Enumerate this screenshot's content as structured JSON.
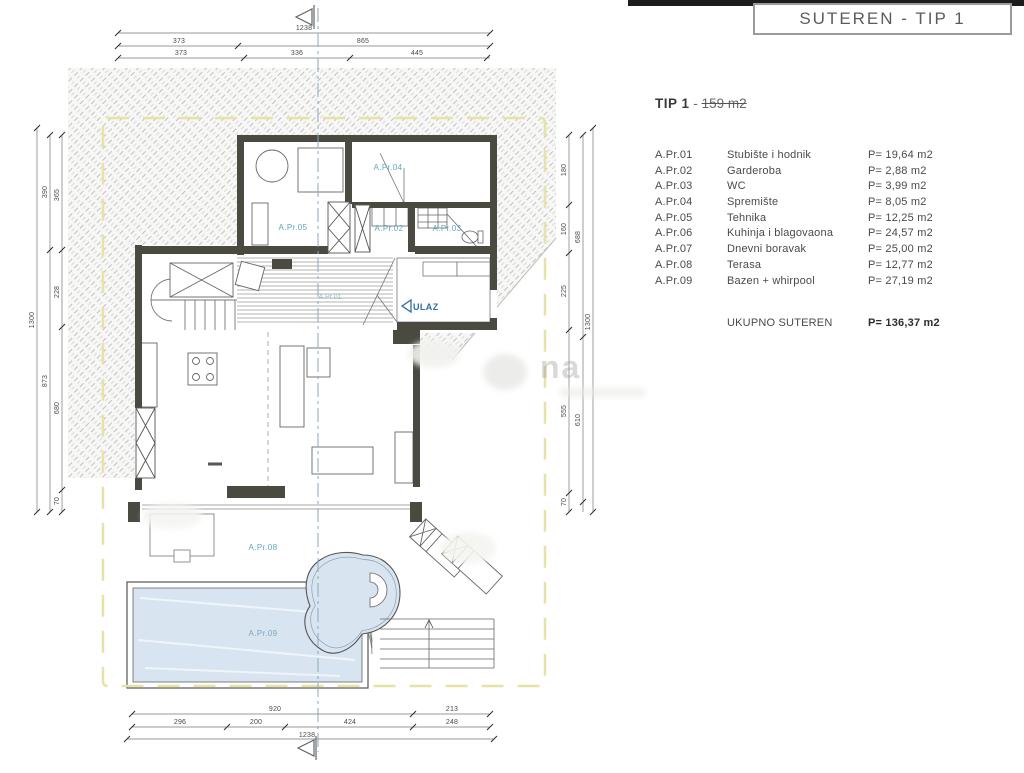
{
  "header": {
    "title": "SUTEREN - TIP 1"
  },
  "summary": {
    "title_bold": "TIP 1",
    "dash": "-",
    "area_struck": "159 m2"
  },
  "legend": {
    "rows": [
      {
        "code": "A.Pr.01",
        "name": "Stubište i hodnik",
        "area": "P= 19,64 m2"
      },
      {
        "code": "A.Pr.02",
        "name": "Garderoba",
        "area": "P= 2,88 m2"
      },
      {
        "code": "A.Pr.03",
        "name": "WC",
        "area": "P= 3,99 m2"
      },
      {
        "code": "A.Pr.04",
        "name": "Spremište",
        "area": "P= 8,05 m2"
      },
      {
        "code": "A.Pr.05",
        "name": "Tehnika",
        "area": "P= 12,25 m2"
      },
      {
        "code": "A.Pr.06",
        "name": "Kuhinja i blagovaona",
        "area": "P= 24,57 m2"
      },
      {
        "code": "A.Pr.07",
        "name": "Dnevni boravak",
        "area": "P= 25,00 m2"
      },
      {
        "code": "A.Pr.08",
        "name": "Terasa",
        "area": "P= 12,77 m2"
      },
      {
        "code": "A.Pr.09",
        "name": "Bazen + whirpool",
        "area": "P= 27,19 m2"
      }
    ],
    "total_label": "UKUPNO SUTEREN",
    "total_area": "P= 136,37 m2"
  },
  "plan": {
    "labels": {
      "apr01": "A.Pr.01",
      "apr02": "A.Pr.02",
      "apr03": "A.Pr.03",
      "apr04": "A.Pr.04",
      "apr05": "A.Pr.05",
      "apr08": "A.Pr.08",
      "apr09": "A.Pr.09",
      "ulaz": "ULAZ"
    },
    "dims": {
      "top": {
        "total": "1238",
        "row2": [
          "373",
          "865"
        ],
        "row3": [
          "373",
          "336",
          "445"
        ]
      },
      "bottom": {
        "row1": [
          "920",
          "213"
        ],
        "row2": [
          "296",
          "200",
          "424",
          "248"
        ],
        "total": "1238"
      },
      "left": {
        "outer": "1300",
        "mid": [
          "390",
          "873"
        ],
        "inner": [
          "365",
          "228",
          "680",
          "70"
        ]
      },
      "right": {
        "outer": "1300",
        "mid": [
          "688",
          "610"
        ],
        "inner": [
          "180",
          "160",
          "225",
          "555",
          "70"
        ]
      }
    }
  },
  "watermark": "na",
  "colors": {
    "wall": "#4b4a41",
    "pool_fill": "#d8e5f1",
    "room_label_teal": "#5ba7bd",
    "ulaz_blue": "#2f6fa0",
    "boundary_yellow": "#e7e3a6",
    "axis_blue": "#8aa7bd",
    "top_bar": "#1d1d1b"
  }
}
